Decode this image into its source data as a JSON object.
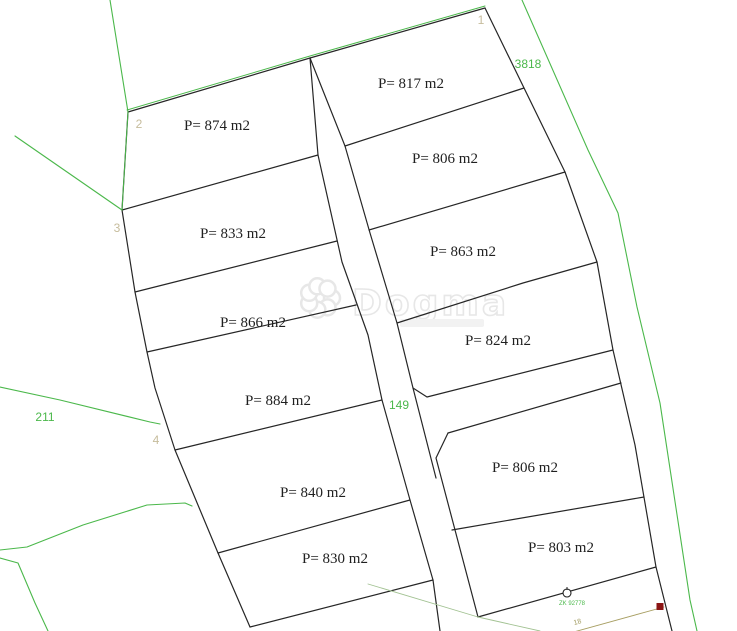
{
  "map": {
    "width": 737,
    "height": 631,
    "background": "#ffffff",
    "colors": {
      "parcel_line": "#262626",
      "boundary_green": "#4bb84b",
      "pale_green": "#a2c292",
      "olive_line": "#a89f63",
      "label_tan": "#c6bc9c",
      "label_green": "#4bb84b",
      "label_olive": "#a09a5e",
      "parcel_text": "#1f1f1f",
      "marker_red": "#8b1414",
      "watermark_gray": "#e3e3e3"
    },
    "parcels": [
      {
        "name": "parcel-874",
        "label": "P= 874 m2",
        "x": 217,
        "y": 130
      },
      {
        "name": "parcel-817",
        "label": "P= 817 m2",
        "x": 411,
        "y": 88
      },
      {
        "name": "parcel-833",
        "label": "P= 833  m2",
        "x": 233,
        "y": 238
      },
      {
        "name": "parcel-806-upper",
        "label": "P= 806  m2",
        "x": 445,
        "y": 163
      },
      {
        "name": "parcel-863",
        "label": "P= 863 m2",
        "x": 463,
        "y": 256
      },
      {
        "name": "parcel-866",
        "label": "P= 866 m2",
        "x": 253,
        "y": 327
      },
      {
        "name": "parcel-824",
        "label": "P= 824 m2",
        "x": 498,
        "y": 345
      },
      {
        "name": "parcel-884",
        "label": "P= 884 m2",
        "x": 278,
        "y": 405
      },
      {
        "name": "parcel-840",
        "label": "P= 840 m2",
        "x": 313,
        "y": 497
      },
      {
        "name": "parcel-806-lower",
        "label": "P= 806 m2",
        "x": 525,
        "y": 472
      },
      {
        "name": "parcel-830",
        "label": "P= 830 m2",
        "x": 335,
        "y": 563
      },
      {
        "name": "parcel-803",
        "label": "P= 803 m2",
        "x": 561,
        "y": 552
      }
    ],
    "lines": [
      {
        "name": "left-edge",
        "color": "parcel_line",
        "width": 1.2,
        "points": "128,112 122,210 135,292 147,352 155,388 175,450 218,553 250,627"
      },
      {
        "name": "ridge-top-edge",
        "color": "parcel_line",
        "width": 1.2,
        "points": "128,112 310,58 485,8"
      },
      {
        "name": "road-left-line",
        "color": "parcel_line",
        "width": 1.2,
        "points": "310,58 318,155 342,262 368,335 382,400 410,500 433,580 440,631"
      },
      {
        "name": "road-right-line",
        "color": "parcel_line",
        "width": 1.2,
        "points": "345,146 370,233 397,323 413,388 436,478"
      },
      {
        "name": "divider-874-833",
        "color": "parcel_line",
        "width": 1.2,
        "points": "122,210 318,155"
      },
      {
        "name": "divider-833-866",
        "color": "parcel_line",
        "width": 1.2,
        "points": "135,292 337,241"
      },
      {
        "name": "divider-866-884",
        "color": "parcel_line",
        "width": 1.2,
        "points": "147,352 356,305"
      },
      {
        "name": "divider-884-840",
        "color": "parcel_line",
        "width": 1.2,
        "points": "175,450 382,400"
      },
      {
        "name": "divider-840-830",
        "color": "parcel_line",
        "width": 1.2,
        "points": "218,553 410,500"
      },
      {
        "name": "bottom-edge-830",
        "color": "parcel_line",
        "width": 1.2,
        "points": "250,627 433,580"
      },
      {
        "name": "divider-874-817",
        "color": "parcel_line",
        "width": 1.2,
        "points": "310,58 345,146"
      },
      {
        "name": "right-edge",
        "color": "parcel_line",
        "width": 1.2,
        "points": "485,8 565,172 597,262 613,350 635,445 656,567 672,631"
      },
      {
        "name": "divider-817-806",
        "color": "parcel_line",
        "width": 1.2,
        "points": "345,146 524,88"
      },
      {
        "name": "divider-806-863",
        "color": "parcel_line",
        "width": 1.2,
        "points": "369,230 565,172"
      },
      {
        "name": "divider-863-824",
        "color": "parcel_line",
        "width": 1.2,
        "points": "397,323 523,283 597,262"
      },
      {
        "name": "bottom-edge-824",
        "color": "parcel_line",
        "width": 1.2,
        "points": "413,388 427,397 613,350"
      },
      {
        "name": "block2-top-edge",
        "color": "parcel_line",
        "width": 1.2,
        "points": "448,433 621,383"
      },
      {
        "name": "block2-left-edge",
        "color": "parcel_line",
        "width": 1.2,
        "points": "448,433 436,458 478,617"
      },
      {
        "name": "divider-806-803",
        "color": "parcel_line",
        "width": 1.2,
        "points": "452,530 644,497"
      },
      {
        "name": "bottom-edge-803",
        "color": "parcel_line",
        "width": 1.2,
        "points": "478,617 656,567"
      },
      {
        "name": "green-north-line",
        "color": "boundary_green",
        "width": 1.1,
        "points": "110,0 128,112"
      },
      {
        "name": "green-west-diagonal",
        "color": "boundary_green",
        "width": 1.1,
        "points": "15,136 122,210"
      },
      {
        "name": "green-left-overlay",
        "color": "boundary_green",
        "width": 1.0,
        "points": "128,112 122,210"
      },
      {
        "name": "green-ridge-overlay",
        "color": "boundary_green",
        "width": 1.0,
        "points": "127,110 310,56 485,6"
      },
      {
        "name": "green-3818-line",
        "color": "boundary_green",
        "width": 1.1,
        "points": "522,0 588,150 618,213 637,307 660,403 690,600 697,631"
      },
      {
        "name": "green-211-line",
        "color": "boundary_green",
        "width": 1.1,
        "points": "0,387 60,400 150,422 160,424"
      },
      {
        "name": "green-curve-upper",
        "color": "boundary_green",
        "width": 1.1,
        "points": "0,550 27,547 83,525 147,505 185,503 192,506"
      },
      {
        "name": "green-curve-lower",
        "color": "boundary_green",
        "width": 1.1,
        "points": "0,558 18,563 35,603 48,631"
      },
      {
        "name": "pale-bottom-line",
        "color": "pale_green",
        "width": 0.9,
        "points": "368,584 478,617 540,631"
      },
      {
        "name": "olive-bottom-line",
        "color": "olive_line",
        "width": 0.9,
        "points": "552,638 664,607"
      }
    ],
    "reference_labels": [
      {
        "name": "point-label-1",
        "text": "1",
        "x": 481,
        "y": 24,
        "color": "label_tan",
        "size": 12
      },
      {
        "name": "point-label-2",
        "text": "2",
        "x": 139,
        "y": 128,
        "color": "label_tan",
        "size": 12
      },
      {
        "name": "point-label-3",
        "text": "3",
        "x": 117,
        "y": 232,
        "color": "label_tan",
        "size": 12
      },
      {
        "name": "point-label-4",
        "text": "4",
        "x": 156,
        "y": 444,
        "color": "label_tan",
        "size": 12
      },
      {
        "name": "cadastral-3818",
        "text": "3818",
        "x": 528,
        "y": 68,
        "color": "label_green",
        "size": 12
      },
      {
        "name": "cadastral-211",
        "text": "211",
        "x": 45,
        "y": 421,
        "color": "label_green",
        "size": 12
      },
      {
        "name": "cadastral-149",
        "text": "149",
        "x": 399,
        "y": 409,
        "color": "label_green",
        "size": 12
      },
      {
        "name": "survey-zk-label",
        "text": "ZK 92778",
        "x": 572,
        "y": 605,
        "color": "label_green",
        "size": 6
      },
      {
        "name": "distance-18",
        "text": "18",
        "x": 578,
        "y": 624,
        "color": "label_olive",
        "size": 7,
        "rotate": -15
      }
    ],
    "markers": {
      "survey_point": {
        "name": "survey-point-marker",
        "x": 567,
        "y": 593,
        "r": 4
      },
      "boundary_point": {
        "name": "red-boundary-point",
        "x": 660,
        "y": 603,
        "size": 7
      }
    },
    "watermark": {
      "name": "dogma-watermark",
      "text": "Dogma",
      "x": 352,
      "y": 315,
      "flower_cx": 320,
      "flower_cy": 298
    }
  }
}
